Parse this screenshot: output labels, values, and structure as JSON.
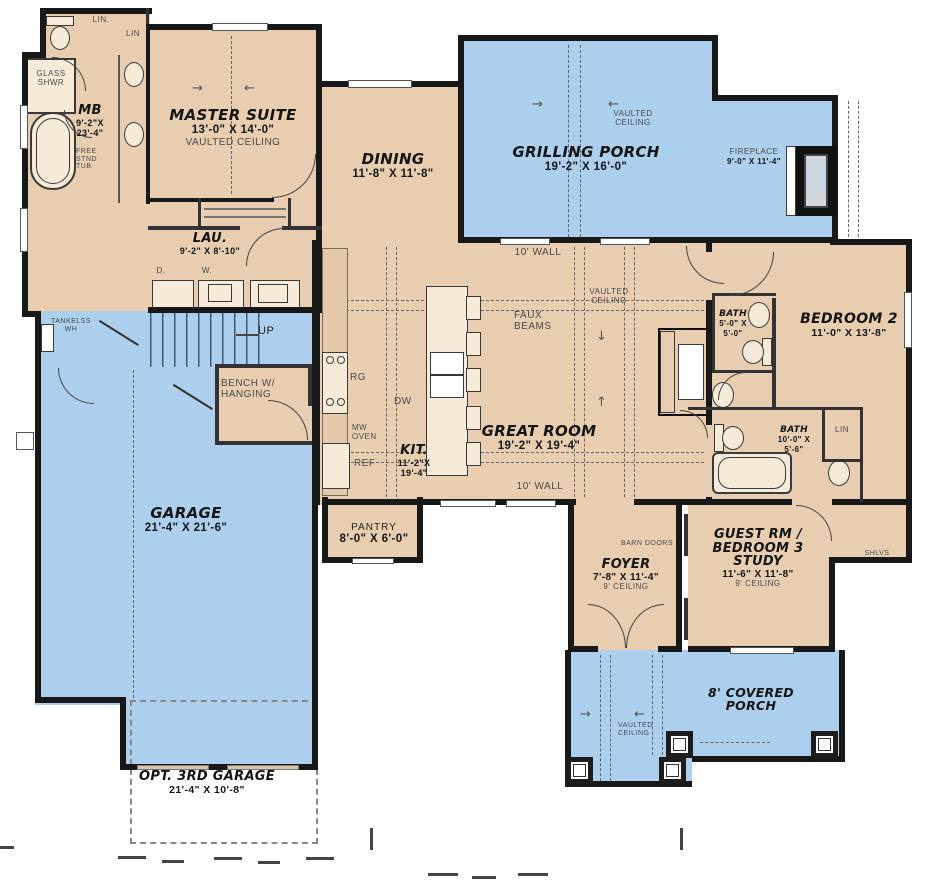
{
  "plan_type": "first-floor house plan",
  "colors": {
    "room_fill": "#e8cdb0",
    "porch_fill": "#abcfec",
    "wall": "#181818"
  },
  "icons": {
    "arrow_right": "→",
    "arrow_left": "←",
    "arrow_up": "↑",
    "arrow_down": "↓"
  },
  "rooms": {
    "closets_top": {
      "lin1": "LIN.",
      "lin2": "LIN"
    },
    "glass_shower": {
      "label": "GLASS SHWR"
    },
    "master_bath": {
      "name": "MB",
      "dims": "9'-2\"X 23'-4\"",
      "tub": "FREE STND TUB"
    },
    "master_suite": {
      "name": "MASTER SUITE",
      "dims": "13'-0\" X 14'-0\"",
      "note": "VAULTED CEILING"
    },
    "laundry": {
      "name": "LAU.",
      "dims": "9'-2\" X 8'-10\"",
      "dryer": "D.",
      "washer": "W."
    },
    "dining": {
      "name": "DINING",
      "dims": "11'-8\" X 11'-8\""
    },
    "grilling_porch": {
      "name": "GRILLING PORCH",
      "dims": "19'-2\" X 16'-0\"",
      "note": "VAULTED CEILING"
    },
    "fireplace": {
      "name": "FIREPLACE",
      "dims": "9'-0\" X 11'-4\""
    },
    "great_room": {
      "name": "GREAT ROOM",
      "dims": "19'-2\" X 19'-4\"",
      "note": "VAULTED CEILING",
      "faux_beams": "FAUX BEAMS",
      "wall_note": "10' WALL"
    },
    "kitchen": {
      "name": "KIT.",
      "dims": "11'-2\"X 19'-4\"",
      "range": "RG",
      "dishwasher": "DW",
      "microwave": "MW OVEN",
      "fridge": "REF"
    },
    "mud_hall": {
      "bench": "BENCH W/ HANGING",
      "up": "UP",
      "water_heater": "TANKELSS WH"
    },
    "garage": {
      "name": "GARAGE",
      "dims": "21'-4\" X 21'-6\""
    },
    "opt_garage": {
      "name": "OPT. 3RD GARAGE",
      "dims": "21'-4\" X 10'-8\""
    },
    "pantry": {
      "name": "PANTRY",
      "dims": "8'-0\" X 6'-0\""
    },
    "foyer": {
      "name": "FOYER",
      "dims": "7'-8\" X 11'-4\"",
      "note": "9' CEILING",
      "barn_doors": "BARN DOORS"
    },
    "bath1": {
      "name": "BATH",
      "dims": "5'-0\" X 5'-0\""
    },
    "bedroom2": {
      "name": "BEDROOM 2",
      "dims": "11'-0\" X 13'-8\""
    },
    "bath2": {
      "name": "BATH",
      "dims": "10'-0\" X 5'-6\"",
      "lin": "LIN"
    },
    "guest": {
      "name1": "GUEST RM /",
      "name2": "BEDROOM 3",
      "name3": "STUDY",
      "dims": "11'-6\" X 11'-8\"",
      "note": "9' CEILING",
      "shelves": "SHLVS"
    },
    "covered_porch": {
      "name": "8' COVERED PORCH",
      "note": "VAULTED CEILING"
    }
  }
}
